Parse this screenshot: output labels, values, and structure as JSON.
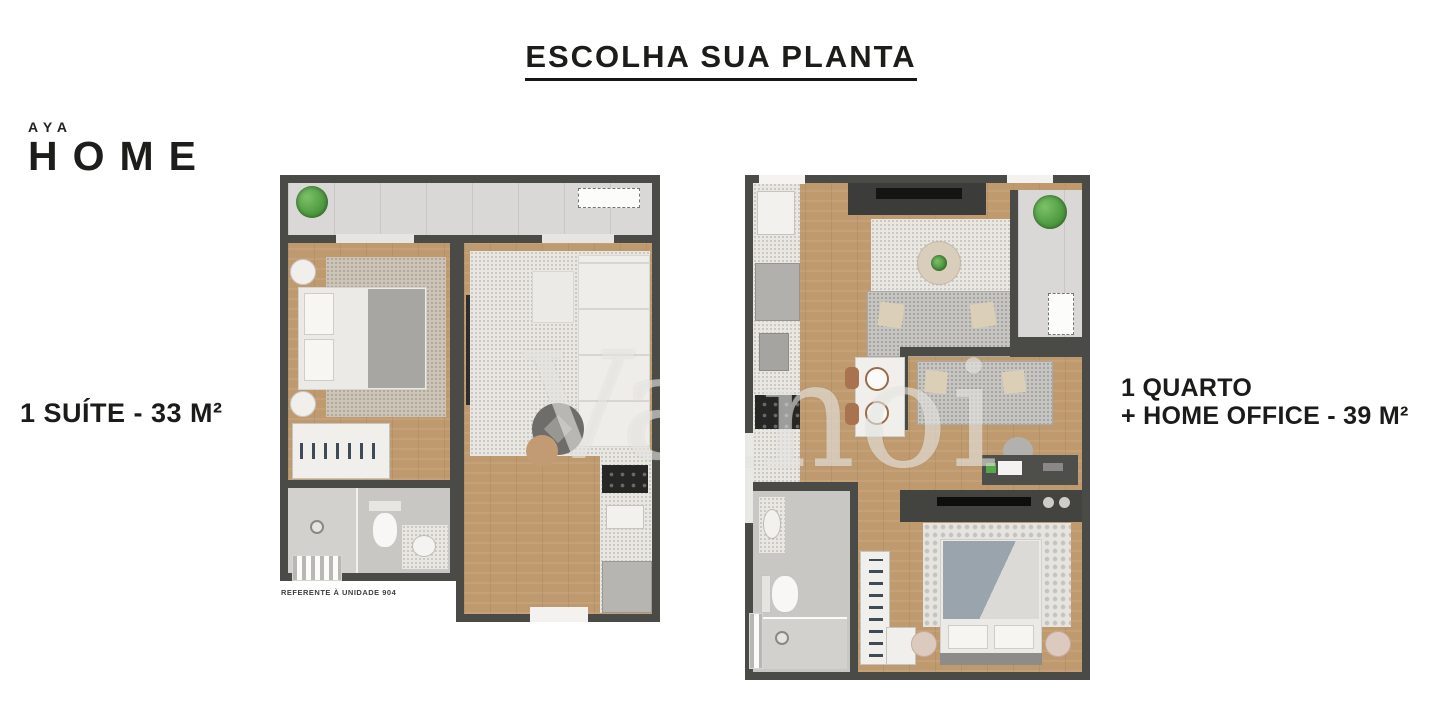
{
  "title": "ESCOLHA SUA PLANTA",
  "logo": {
    "brand_top": "AYA",
    "brand_main": "HOME"
  },
  "watermark": "Vanoi",
  "plans": [
    {
      "label": "1 SUÍTE - 33 M²",
      "caption": "REFERENTE À UNIDADE 904"
    },
    {
      "label_line1": "1 QUARTO",
      "label_line2": "+ HOME OFFICE - 39 M²"
    }
  ],
  "colors": {
    "text": "#1c1c1a",
    "wall": "#4a4a47",
    "wood_floor": "#c09a6f",
    "balcony_tile": "#d9d8d6",
    "plant_green": "#4e9a41",
    "appliance_dark": "#262624",
    "watermark_gray": "#f3f2ef"
  }
}
